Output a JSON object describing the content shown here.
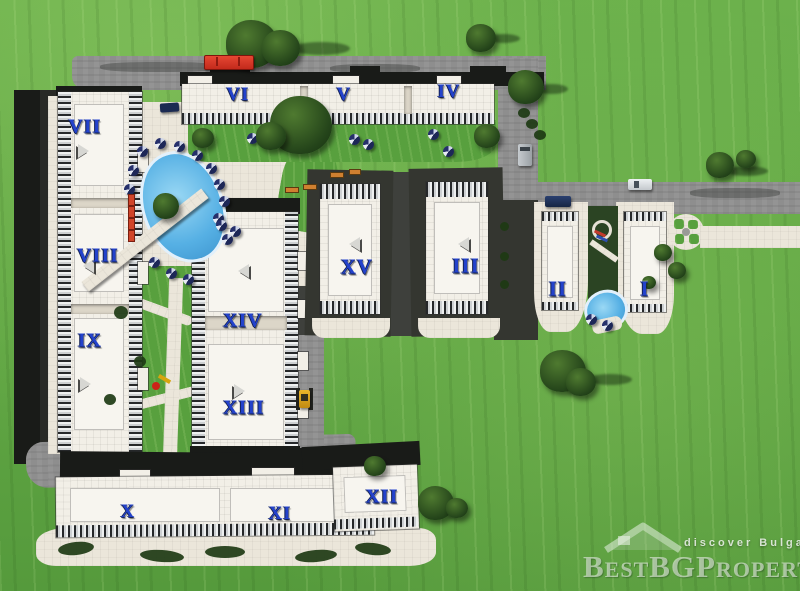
{
  "site_plan": {
    "buildings": [
      {
        "id": "I",
        "label": "I"
      },
      {
        "id": "II",
        "label": "II"
      },
      {
        "id": "III",
        "label": "III"
      },
      {
        "id": "IV",
        "label": "IV"
      },
      {
        "id": "V",
        "label": "V"
      },
      {
        "id": "VI",
        "label": "VI"
      },
      {
        "id": "VII",
        "label": "VII"
      },
      {
        "id": "VIII",
        "label": "VIII"
      },
      {
        "id": "IX",
        "label": "IX"
      },
      {
        "id": "X",
        "label": "X"
      },
      {
        "id": "XI",
        "label": "XI"
      },
      {
        "id": "XII",
        "label": "XII"
      },
      {
        "id": "XIII",
        "label": "XIII"
      },
      {
        "id": "XIV",
        "label": "XIV"
      },
      {
        "id": "XV",
        "label": "XV"
      }
    ],
    "watermark": {
      "tagline": "discover Bulgaria",
      "brand": "BestBGProperties",
      "logo_icon": "house-roof-icon"
    },
    "features": {
      "main_pool": "swimming-pool",
      "kids_pool": "small-pool",
      "roundabout": "circular-garden-path",
      "playground": "playground-equipment",
      "vehicles": [
        "red-truck",
        "silver-van",
        "navy-car",
        "white-car",
        "navy-car",
        "yellow-loader"
      ]
    },
    "colors": {
      "grass": "#63a944",
      "road": "#8e8e8e",
      "building_white": "#f2efe7",
      "label_blue": "#2342cc",
      "pool_blue": "#56b0e4",
      "shadow_dark": "#191b18",
      "truck_red": "#d93425",
      "loader_yellow": "#d9a41f"
    }
  }
}
